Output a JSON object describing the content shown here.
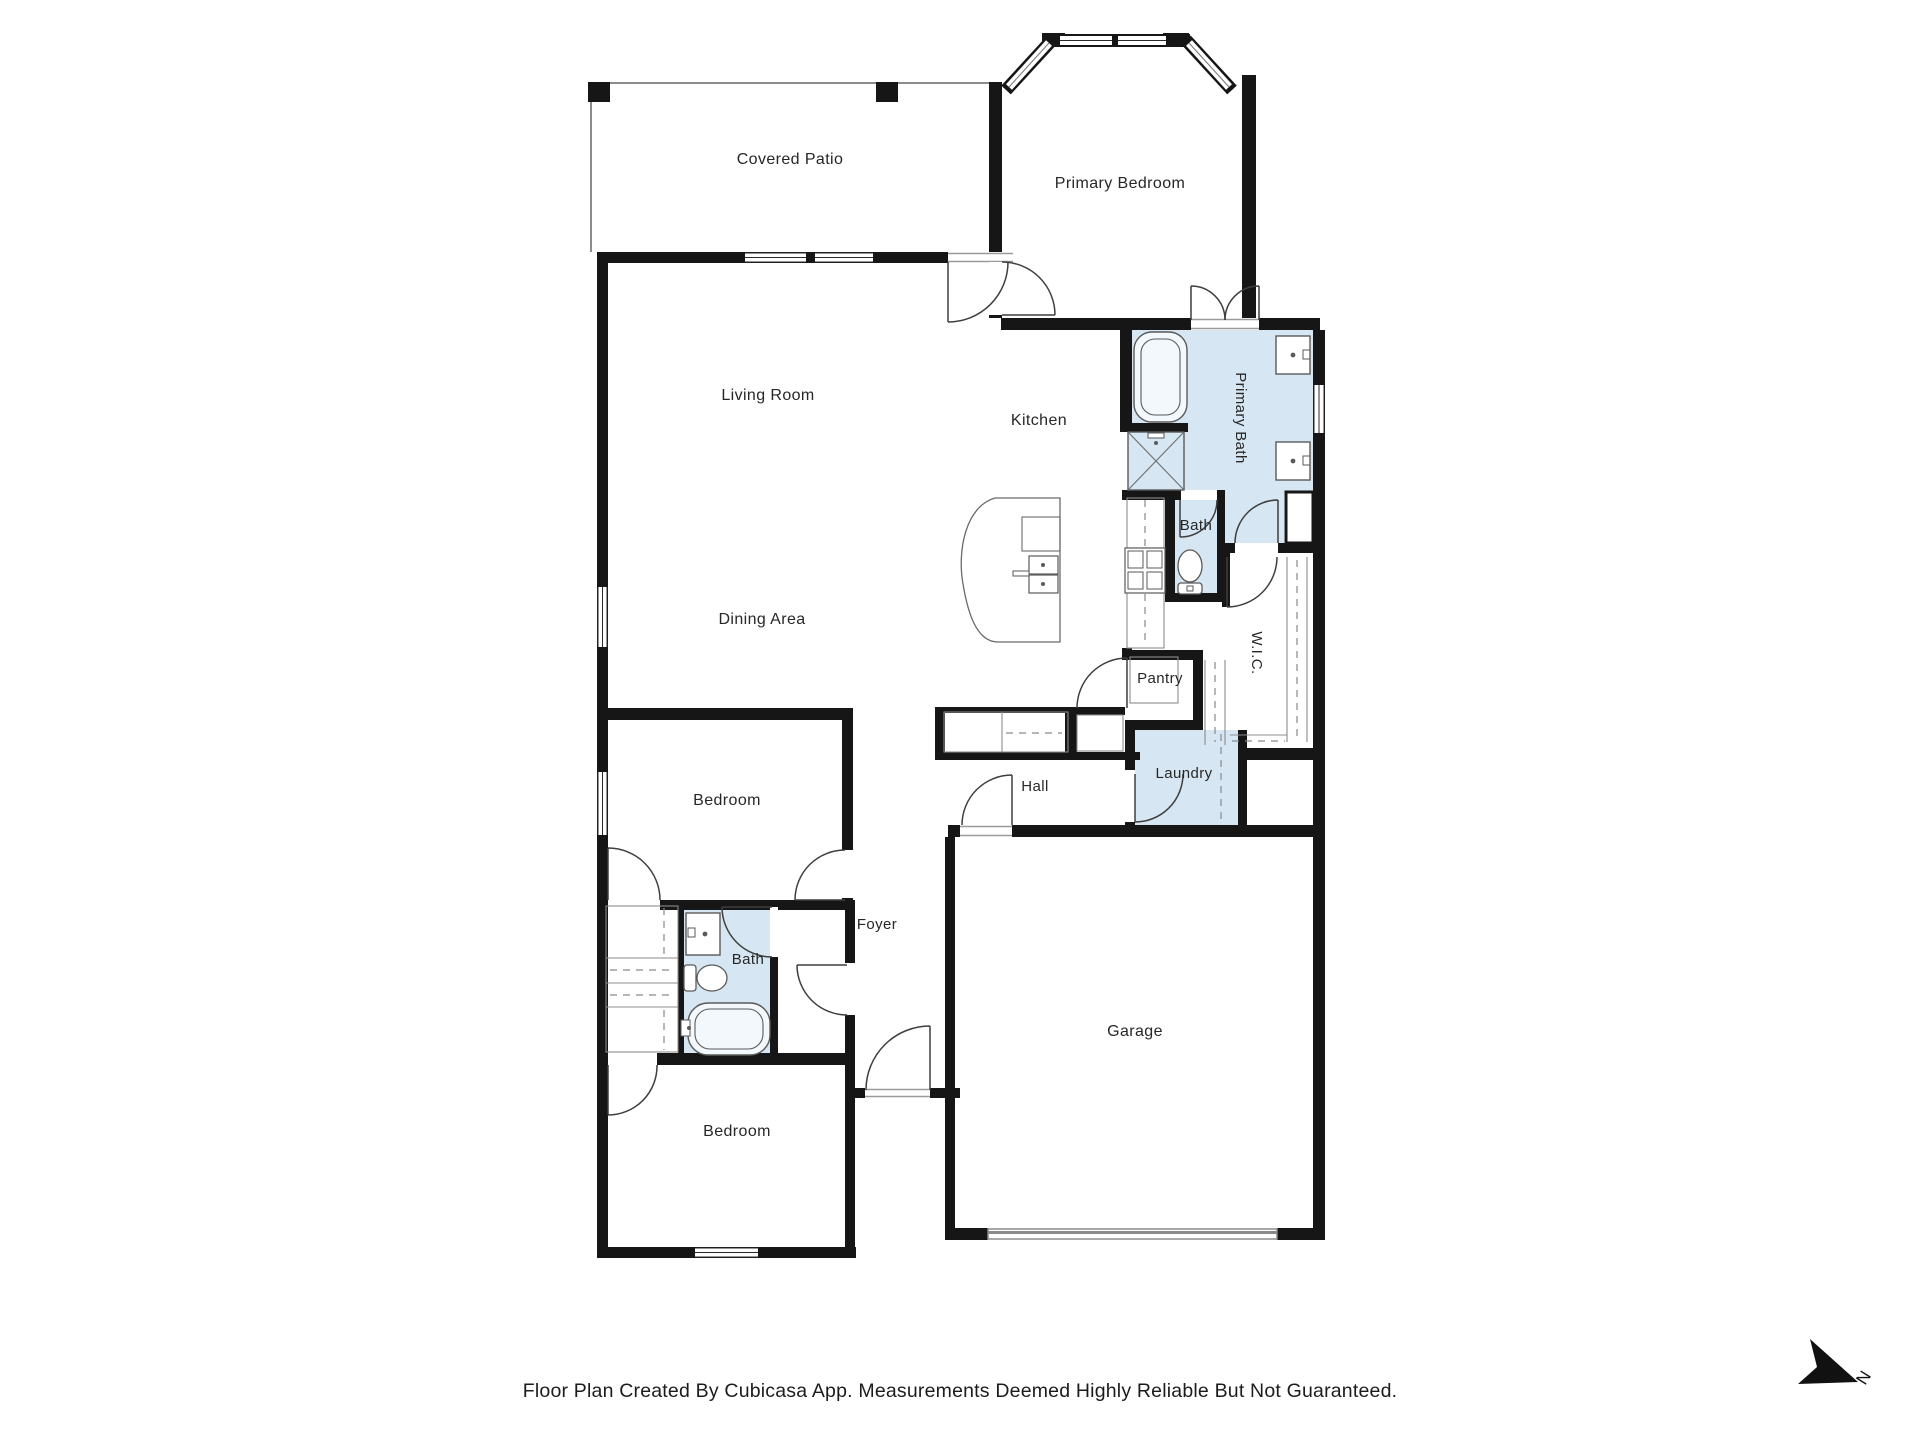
{
  "title": "Cubicasa floor plan",
  "colors": {
    "wall": "#161616",
    "wet_room_fill": "#d6e7f3",
    "background": "#ffffff",
    "label_text": "#272727",
    "footer_text": "#1c1c1c"
  },
  "rooms": [
    {
      "id": "covered-patio",
      "label": "Covered Patio",
      "x": 790,
      "y": 160,
      "rot": 0,
      "size": 16
    },
    {
      "id": "primary-bedroom",
      "label": "Primary Bedroom",
      "x": 1120,
      "y": 184,
      "rot": 0,
      "size": 16
    },
    {
      "id": "living-room",
      "label": "Living Room",
      "x": 768,
      "y": 396,
      "rot": 0,
      "size": 16
    },
    {
      "id": "kitchen",
      "label": "Kitchen",
      "x": 1039,
      "y": 421,
      "rot": 0,
      "size": 16
    },
    {
      "id": "primary-bath",
      "label": "Primary Bath",
      "x": 1240,
      "y": 418,
      "rot": 90,
      "size": 15
    },
    {
      "id": "bath-upper",
      "label": "Bath",
      "x": 1196,
      "y": 526,
      "rot": 0,
      "size": 15
    },
    {
      "id": "dining-area",
      "label": "Dining Area",
      "x": 762,
      "y": 620,
      "rot": 0,
      "size": 16
    },
    {
      "id": "wic",
      "label": "W.I.C.",
      "x": 1256,
      "y": 653,
      "rot": 90,
      "size": 15
    },
    {
      "id": "pantry",
      "label": "Pantry",
      "x": 1160,
      "y": 679,
      "rot": 0,
      "size": 15
    },
    {
      "id": "hall",
      "label": "Hall",
      "x": 1035,
      "y": 787,
      "rot": 0,
      "size": 15
    },
    {
      "id": "laundry",
      "label": "Laundry",
      "x": 1184,
      "y": 774,
      "rot": 0,
      "size": 15
    },
    {
      "id": "bedroom-1",
      "label": "Bedroom",
      "x": 727,
      "y": 801,
      "rot": 0,
      "size": 16
    },
    {
      "id": "foyer",
      "label": "Foyer",
      "x": 877,
      "y": 925,
      "rot": 0,
      "size": 15
    },
    {
      "id": "bath-lower",
      "label": "Bath",
      "x": 748,
      "y": 960,
      "rot": 0,
      "size": 15
    },
    {
      "id": "bedroom-2",
      "label": "Bedroom",
      "x": 737,
      "y": 1132,
      "rot": 0,
      "size": 16
    },
    {
      "id": "garage",
      "label": "Garage",
      "x": 1135,
      "y": 1032,
      "rot": 0,
      "size": 16
    }
  ],
  "footer": {
    "text": "Floor Plan Created By Cubicasa App. Measurements Deemed Highly Reliable But Not Guaranteed."
  },
  "north": {
    "label": "N"
  }
}
